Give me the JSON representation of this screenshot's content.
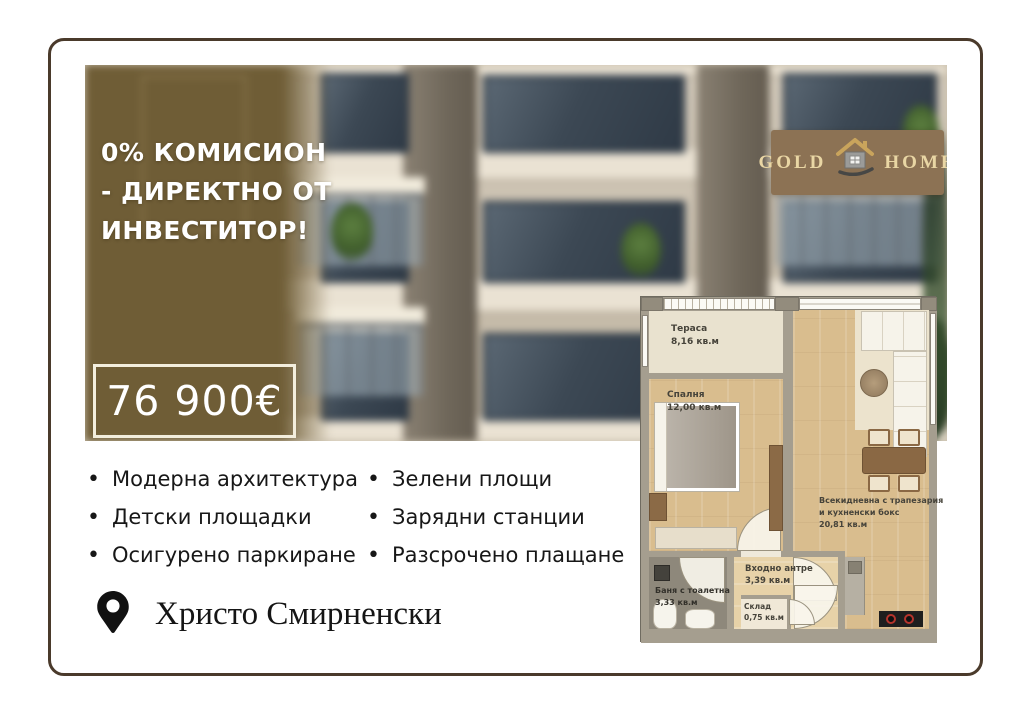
{
  "promo": {
    "lines": [
      "0% КОМИСИОН",
      "- ДИРЕКТНО ОТ",
      "ИНВЕСТИТОР!"
    ]
  },
  "price": {
    "value": "76 900€"
  },
  "logo": {
    "word_left": "GOLD",
    "word_right": "HOME",
    "icon": "house-icon"
  },
  "features": {
    "column1": [
      "Модерна архитектура",
      "Детски площадки",
      "Осигурено паркиране"
    ],
    "column2": [
      "Зелени площи",
      "Зарядни станции",
      "Разсрочено плащане"
    ]
  },
  "location": {
    "name": "Христо Смирненски",
    "icon": "map-pin-icon"
  },
  "floorplan": {
    "terrace": {
      "name": "Тераса",
      "area": "8,16 кв.м"
    },
    "bedroom": {
      "name": "Спалня",
      "area": "12,00 кв.м"
    },
    "living": {
      "name_line1": "Всекидневна с трапезария",
      "name_line2": "и кухненски бокс",
      "area": "20,81 кв.м"
    },
    "bathroom": {
      "name": "Баня с тоалетна",
      "area": "3,33 кв.м"
    },
    "hall": {
      "name": "Входно антре",
      "area": "3,39 кв.м"
    },
    "storage": {
      "name": "Склад",
      "area": "0,75 кв.м"
    }
  },
  "colors": {
    "card_border": "#4a3a2b",
    "overlay_olive": "#6f5d36",
    "logo_bg": "#8c7254",
    "logo_text": "#e9d6a4",
    "price_text": "#ffffff"
  }
}
